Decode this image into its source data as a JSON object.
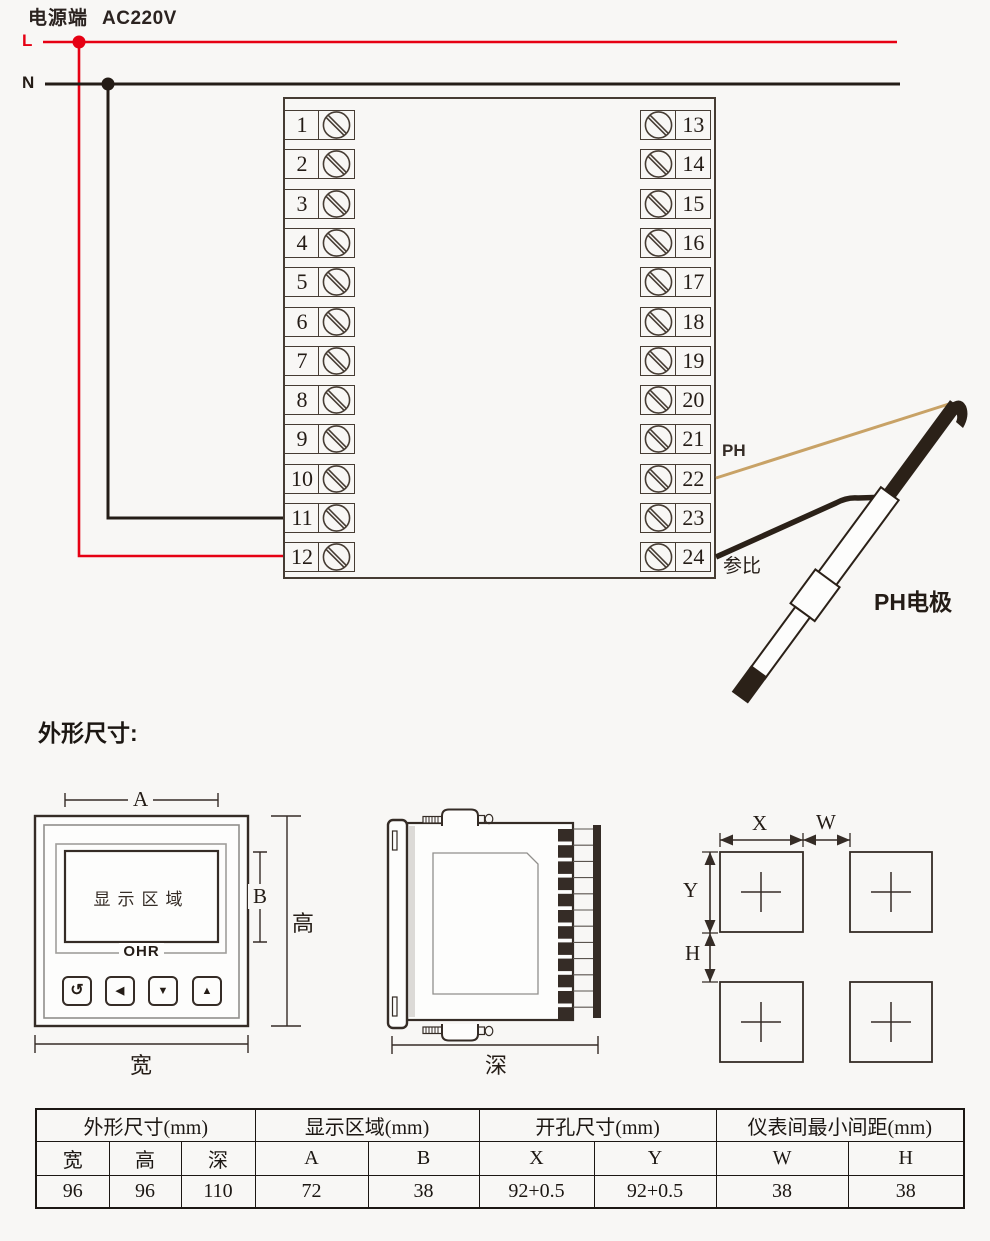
{
  "power": {
    "terminal_label": "电源端",
    "voltage": "AC220V",
    "live_label": "L",
    "neutral_label": "N"
  },
  "colors": {
    "live_wire": "#e60013",
    "neutral_wire": "#241c16",
    "ph_wire": "#c8a266",
    "outline": "#352c26"
  },
  "terminals": {
    "left": [
      "1",
      "2",
      "3",
      "4",
      "5",
      "6",
      "7",
      "8",
      "9",
      "10",
      "11",
      "12"
    ],
    "right": [
      "13",
      "14",
      "15",
      "16",
      "17",
      "18",
      "19",
      "20",
      "21",
      "22",
      "23",
      "24"
    ]
  },
  "electrode": {
    "ph_label": "PH",
    "reference_label": "参比",
    "title": "PH电极"
  },
  "dimensions": {
    "section_title": "外形尺寸:",
    "front": {
      "display_width_label": "A",
      "display_height_label": "B",
      "height_label": "高",
      "width_label": "宽",
      "display_area_label": "显示区域",
      "logo": "OHR",
      "buttons": [
        "↺",
        "◀",
        "▼",
        "▲"
      ]
    },
    "side": {
      "depth_label": "深"
    },
    "cutout": {
      "x_label": "X",
      "w_label": "W",
      "y_label": "Y",
      "h_label": "H"
    }
  },
  "table": {
    "groups": [
      {
        "label": "外形尺寸(mm)"
      },
      {
        "label": "显示区域(mm)"
      },
      {
        "label": "开孔尺寸(mm)"
      },
      {
        "label": "仪表间最小间距(mm)"
      }
    ],
    "columns": [
      "宽",
      "高",
      "深",
      "A",
      "B",
      "X",
      "Y",
      "W",
      "H"
    ],
    "values": [
      "96",
      "96",
      "110",
      "72",
      "38",
      "92+0.5",
      "92+0.5",
      "38",
      "38"
    ]
  }
}
